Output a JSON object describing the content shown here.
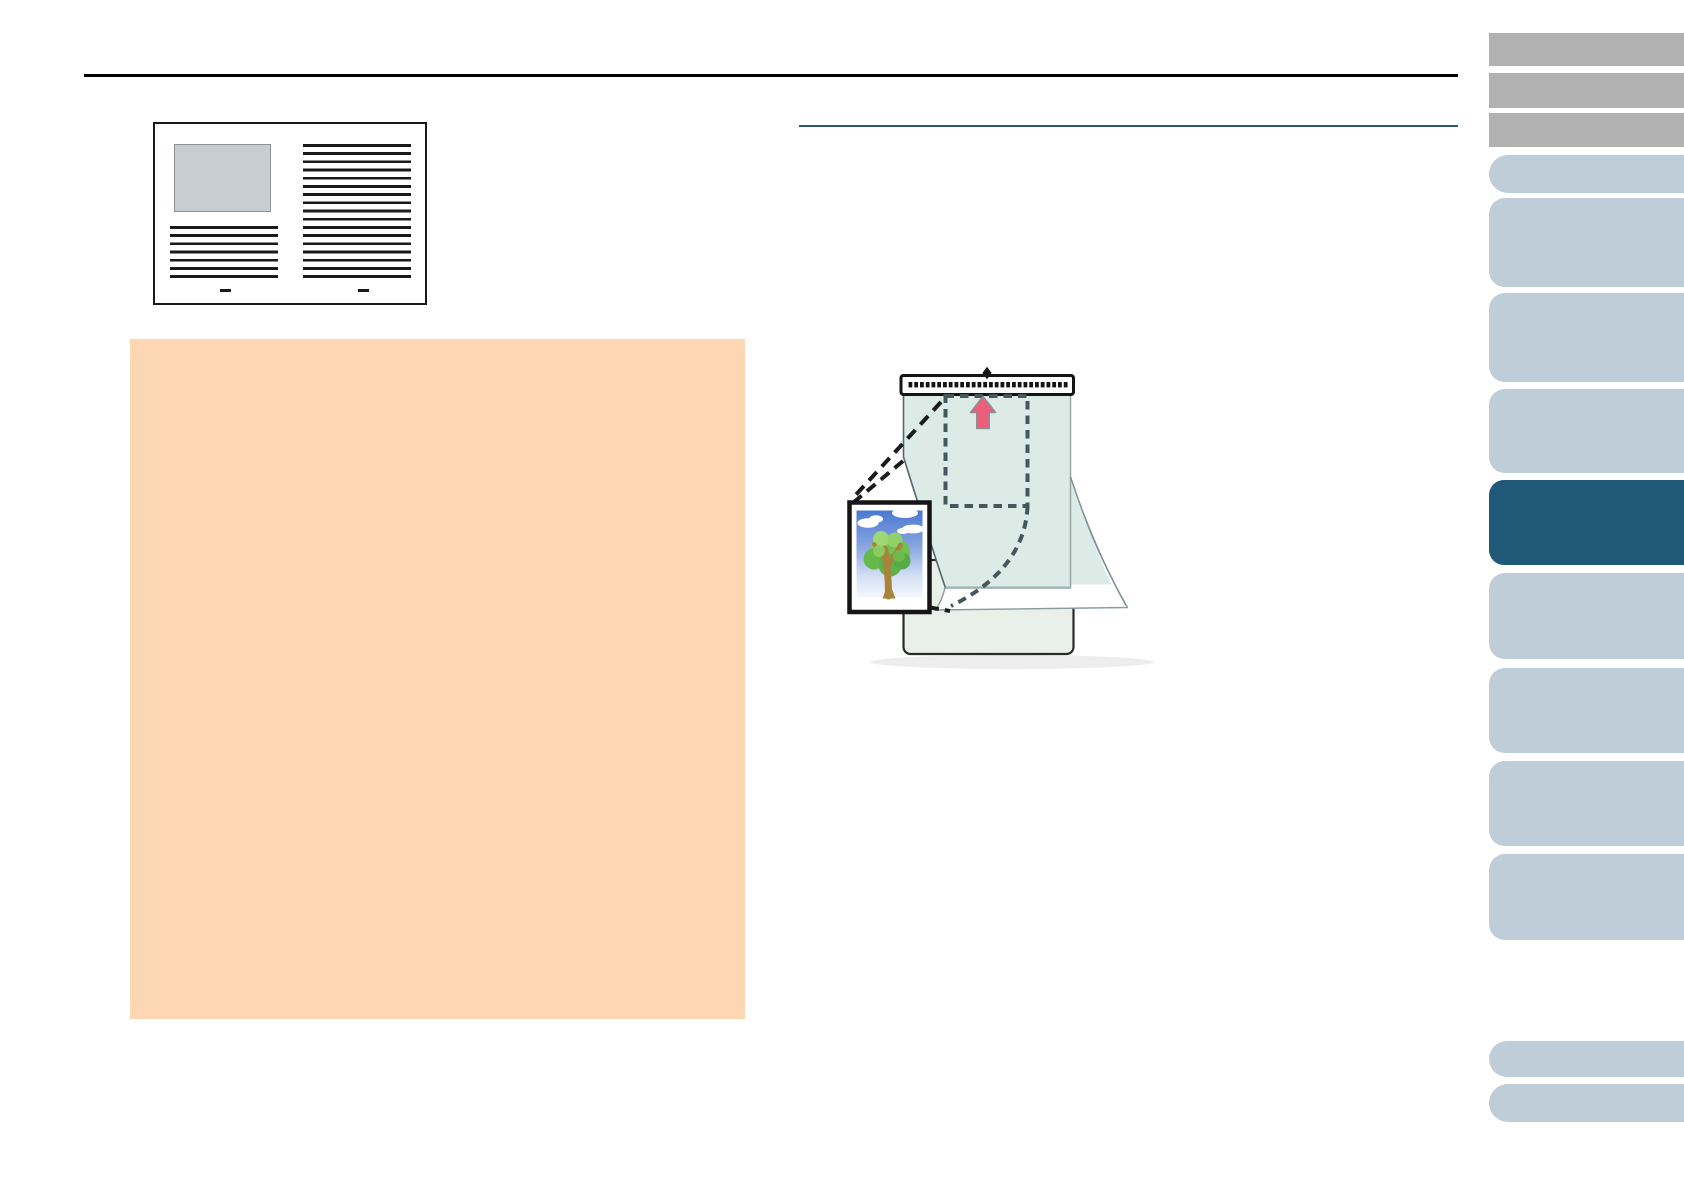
{
  "page": {
    "title": "Scanner Operator Guide page - Carrier Sheet section (no rendered text)",
    "background": "#ffffff"
  },
  "colors": {
    "page_bg": "#ffffff",
    "rule_black": "#000000",
    "rule_teal": "#2e5a74",
    "attention_bg": "#fcd7b1",
    "sidebar_gray": "#b1b1b1",
    "sidebar_blue": "#becdd7",
    "sidebar_active": "#205878",
    "sheet_teal": "#dcebe6",
    "sheet_back": "#e9efe9",
    "strip_ink": "#141414",
    "dash_slate": "#44585c",
    "dash_ink": "#1c1c1c",
    "arrow_pink": "#ec5e7c",
    "doc_ink": "#1a1a1a",
    "doc_image_gray": "#c8cdd3"
  },
  "figures": {
    "document_sample": {
      "name": "sample-document-figure",
      "parts": [
        "image-placeholder",
        "text-lines-left-column",
        "text-lines-right-column",
        "footer-marks"
      ]
    },
    "carrier_sheet": {
      "name": "carrier-sheet-figure",
      "parts": [
        "pattern-strip",
        "set-mark-diamond",
        "placement-dashed-outline",
        "feed-direction-arrow",
        "photograph-with-tree",
        "curled-transparent-front",
        "sheet-back-panel",
        "callout-dashed-lines"
      ]
    }
  },
  "sidebar": {
    "items": [
      {
        "name": "toolbar-button-1",
        "variant": "gray",
        "top": 33,
        "height": 33
      },
      {
        "name": "toolbar-button-2",
        "variant": "gray",
        "top": 73,
        "height": 35
      },
      {
        "name": "toolbar-button-3",
        "variant": "gray",
        "top": 113,
        "height": 34
      },
      {
        "name": "chapter-tab-1",
        "variant": "pill",
        "top": 155,
        "height": 38
      },
      {
        "name": "chapter-tab-2",
        "variant": "blue",
        "top": 198,
        "height": 89
      },
      {
        "name": "chapter-tab-3",
        "variant": "blue",
        "top": 293,
        "height": 89
      },
      {
        "name": "chapter-tab-4",
        "variant": "blue",
        "top": 389,
        "height": 84
      },
      {
        "name": "chapter-tab-5",
        "variant": "active",
        "top": 480,
        "height": 85
      },
      {
        "name": "chapter-tab-6",
        "variant": "blue",
        "top": 573,
        "height": 86
      },
      {
        "name": "chapter-tab-7",
        "variant": "blue",
        "top": 668,
        "height": 85
      },
      {
        "name": "chapter-tab-8",
        "variant": "blue",
        "top": 761,
        "height": 85
      },
      {
        "name": "chapter-tab-9",
        "variant": "blue",
        "top": 854,
        "height": 86
      },
      {
        "name": "page-nav-pill-1",
        "variant": "pill",
        "top": 1041,
        "height": 36
      },
      {
        "name": "page-nav-pill-2",
        "variant": "pill",
        "top": 1084,
        "height": 38
      }
    ]
  },
  "strip": {
    "dot_count": 28
  }
}
